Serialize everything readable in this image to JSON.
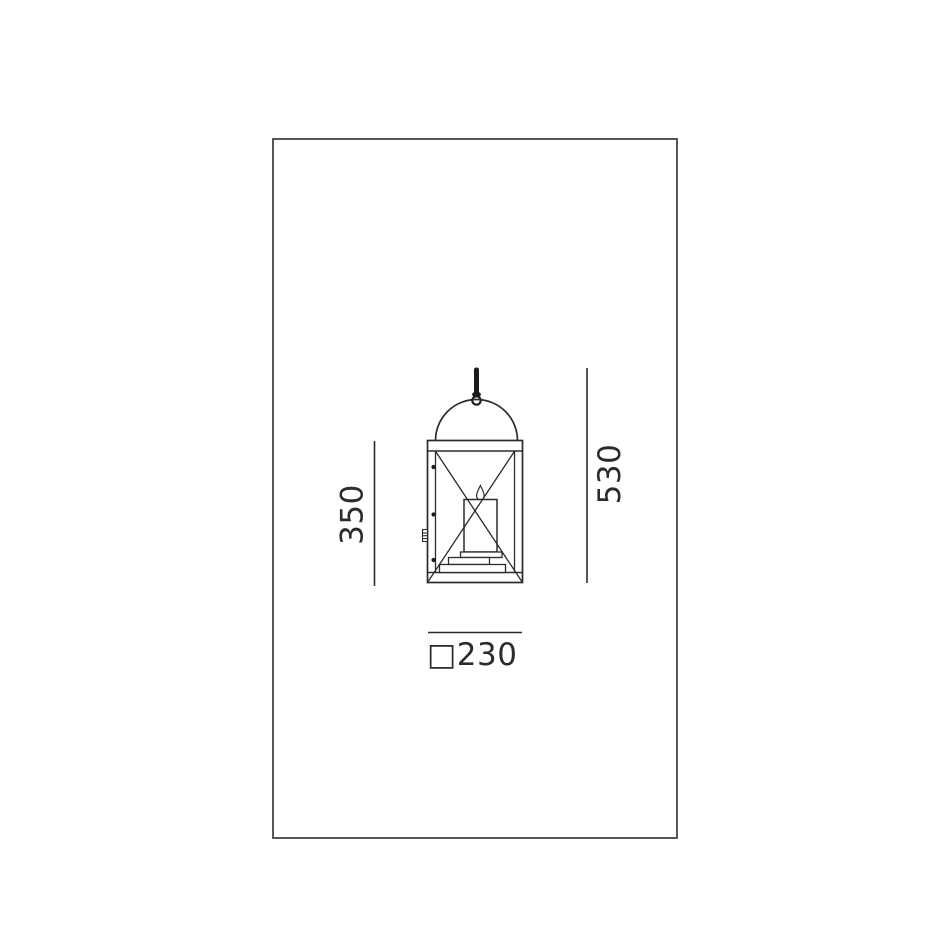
{
  "drawing": {
    "background": "#ffffff",
    "line_color": "#2b2b2b",
    "frame_color": "#3a3a3a",
    "fill_black": "#1c1c1c",
    "dimensions": {
      "body_height": {
        "label": "350"
      },
      "overall_height": {
        "label": "530"
      },
      "width": {
        "label": "□230"
      }
    }
  }
}
